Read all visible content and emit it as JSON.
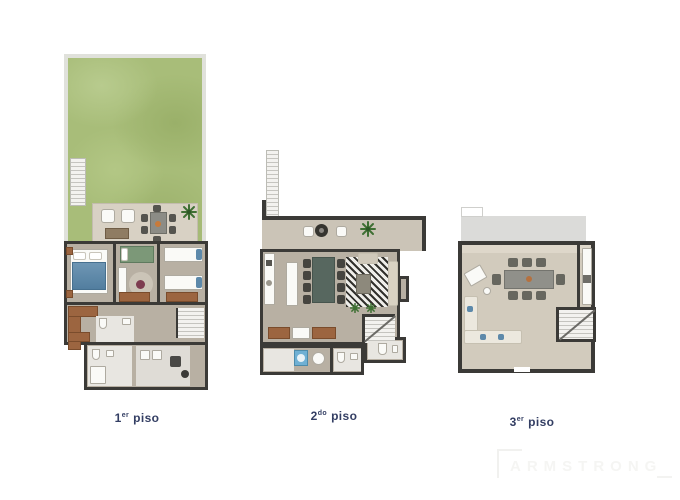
{
  "sheet": {
    "background": "#ffffff"
  },
  "floors": [
    {
      "key": "floor-1",
      "label": {
        "num": "1",
        "sup": "er",
        "word": "piso"
      }
    },
    {
      "key": "floor-2",
      "label": {
        "num": "2",
        "sup": "do",
        "word": "piso"
      }
    },
    {
      "key": "floor-3",
      "label": {
        "num": "3",
        "sup": "er",
        "word": "piso"
      }
    }
  ],
  "watermark": {
    "text": "ARMSTRONG"
  },
  "palette": {
    "label_navy": "#333e63",
    "wall_dark": "#3b3a37",
    "garden_green": "#a8bd79",
    "fence_gray": "#e0e1db",
    "floor_taupe": "#b8b0a3",
    "terrace_beige": "#d8d1c4",
    "roof_gray": "#dbdbd9",
    "bath_white": "#e8e6e1",
    "wood_brown": "#9c6540",
    "bed_blue": "#5e8aab",
    "bed_green": "#7c9878",
    "washer_blue": "#6fb0d4",
    "plant_green": "#3f7034",
    "watermark_gray": "#f5f5f3"
  }
}
